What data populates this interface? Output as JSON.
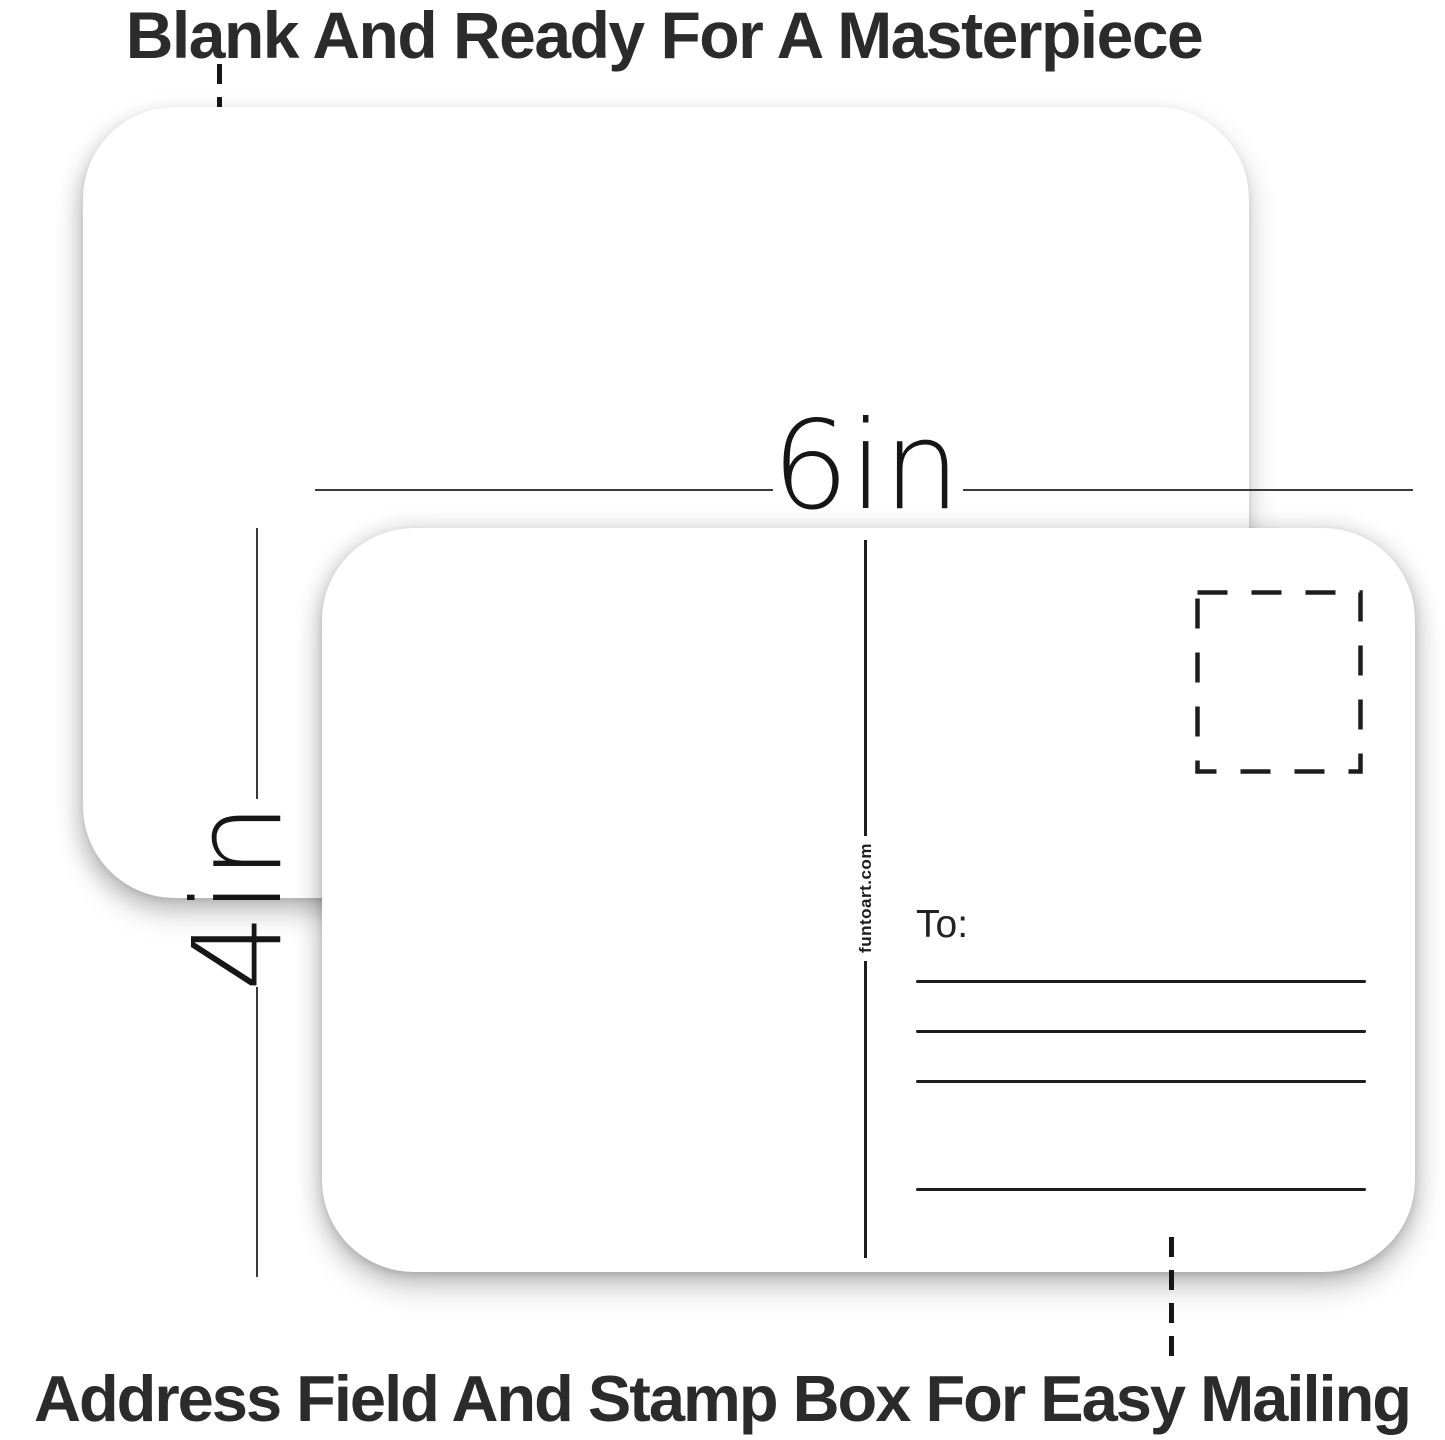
{
  "product_annotations": {
    "top_caption": "Blank And Ready For A Masterpiece",
    "bottom_caption": "Address Field And Stamp Box For Easy Mailing",
    "width_label": "6in",
    "height_label": "4in"
  },
  "postcard_back": {
    "to_label": "To:",
    "watermark": "funtoart.com",
    "address_line_count": 4
  },
  "colors": {
    "background": "#ffffff",
    "card": "#ffffff",
    "ink": "#1d1d1d",
    "caption_text": "#2b2b2b"
  }
}
